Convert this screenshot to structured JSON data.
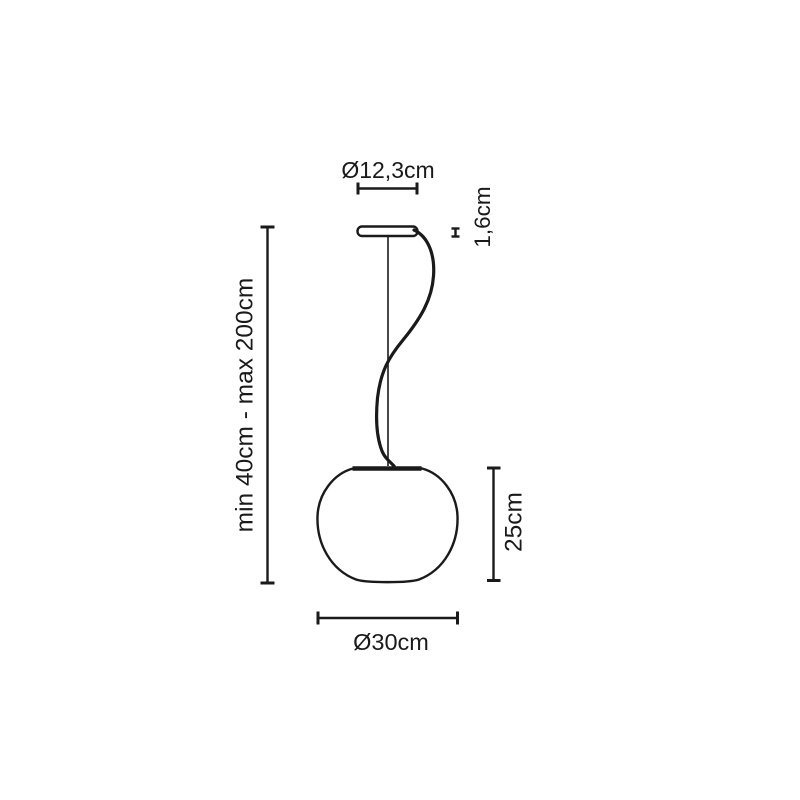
{
  "page": {
    "background_color": "#ffffff",
    "line_color": "#1a1a1a"
  },
  "diagram": {
    "subject": "pendant-lamp-dimension-drawing",
    "labels": {
      "canopy_diameter": "Ø12,3cm",
      "canopy_thickness": "1,6cm",
      "suspension_length": "min 40cm - max 200cm",
      "diffuser_height": "25cm",
      "diffuser_diameter": "Ø30cm"
    }
  }
}
